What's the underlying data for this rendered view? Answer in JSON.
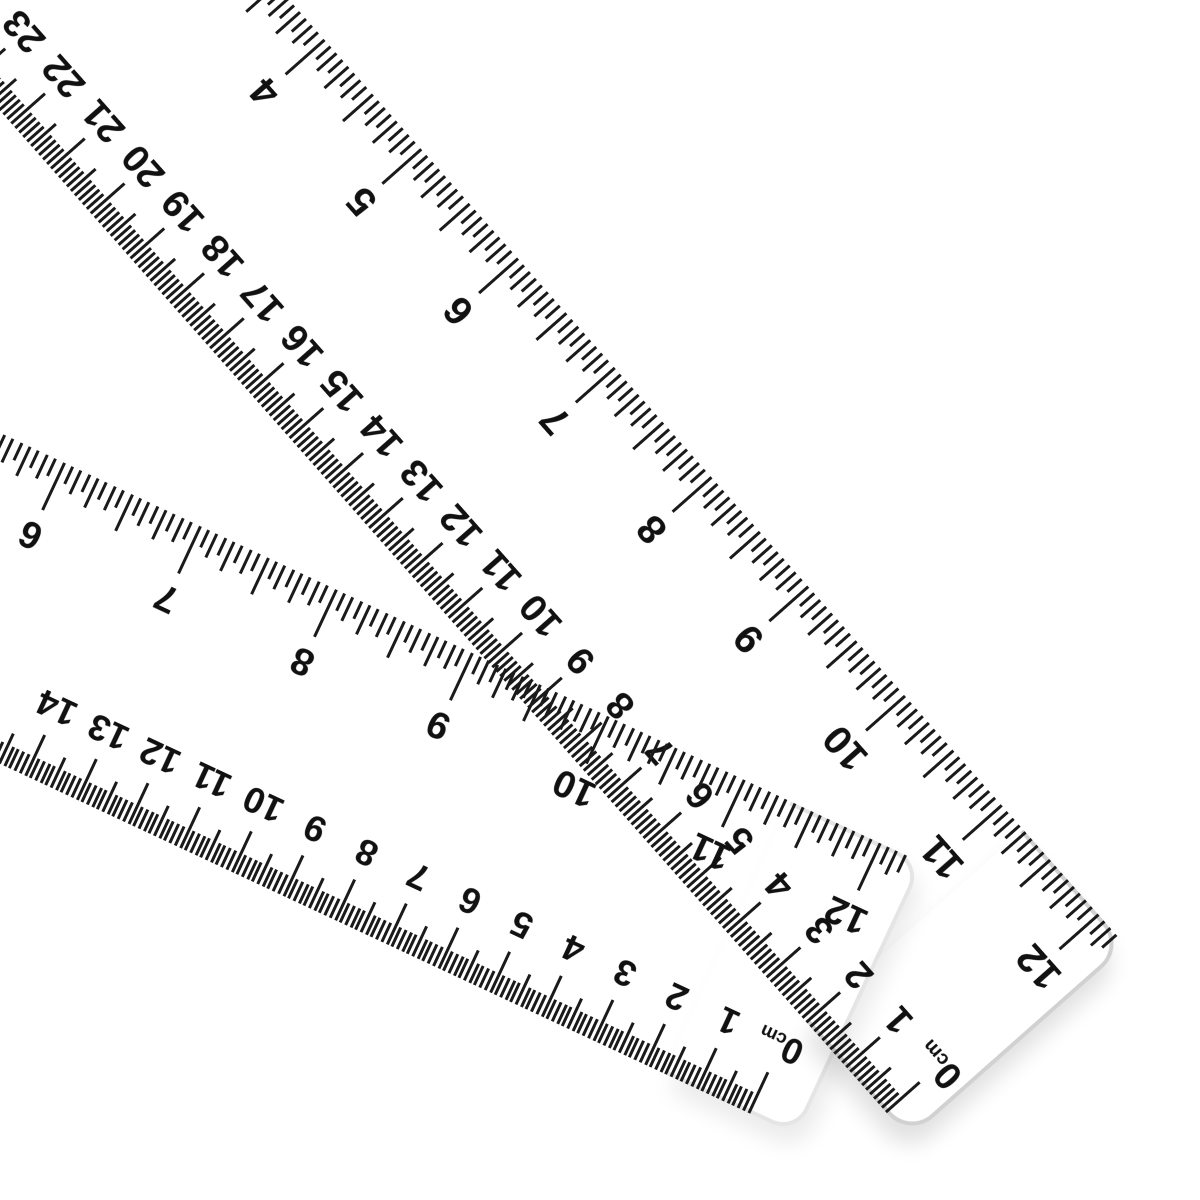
{
  "canvas": {
    "width": 1200,
    "height": 1200,
    "background_color": "#ffffff"
  },
  "style": {
    "tick_color": "#1a1a1a",
    "number_color": "#111111",
    "endcap_outline_color_strong": "rgba(0,0,0,0.18)",
    "endcap_outline_color_faint": "rgba(0,0,0,0.10)",
    "endcap_shadow_strong": "rgba(0,0,0,0.12)",
    "endcap_shadow_faint": "rgba(0,0,0,0.08)"
  },
  "rulers": [
    {
      "id": "ruler-a",
      "angle_deg": 48.5,
      "origin_x": -131,
      "origin_y": -475,
      "length_px": 1900,
      "width_px": 290,
      "endcap": {
        "left": 1742,
        "width": 152,
        "corner_radius": 32,
        "outline": "strong",
        "shadow": "strong"
      },
      "scales": [
        {
          "name": "inch",
          "side": "top",
          "subdivisions": 16,
          "px_per_unit": 146,
          "ref_value": 12,
          "ref_x": 1855,
          "value_sign": 1,
          "min_value": 0,
          "max_value": 12.1875,
          "tick_lengths": {
            "unit": 52,
            "half": 40,
            "quarter": 32,
            "eighth": 26,
            "minor": 19
          },
          "tick_width": 3,
          "number_font_px": 40,
          "number_inset_px": 58,
          "numbers": [
            4,
            5,
            6,
            7,
            8,
            9,
            10,
            11,
            12
          ],
          "zero_label": null
        },
        {
          "name": "cm",
          "side": "bottom",
          "subdivisions": 10,
          "px_per_unit": 60,
          "ref_value": 0,
          "ref_x": 1862,
          "value_sign": -1,
          "min_value": 0,
          "max_value": 31,
          "tick_lengths": {
            "unit": 45,
            "half": 33,
            "quarter": 22,
            "eighth": 22,
            "minor": 22
          },
          "tick_width": 3,
          "number_font_px": 38,
          "number_inset_px": 52,
          "numbers": [
            23,
            22,
            21,
            20,
            19,
            18,
            17,
            16,
            15,
            14,
            13,
            12,
            11,
            10,
            9,
            8,
            7,
            6,
            5,
            4,
            3,
            2,
            1
          ],
          "zero_label": {
            "number": "0",
            "unit": "cm"
          }
        }
      ]
    },
    {
      "id": "ruler-b",
      "angle_deg": 25,
      "origin_x": -525,
      "origin_y": 188,
      "length_px": 1600,
      "width_px": 300,
      "endcap": {
        "left": 1452,
        "width": 142,
        "corner_radius": 28,
        "outline": "faint",
        "shadow": "faint"
      },
      "scales": [
        {
          "name": "inch",
          "side": "top",
          "subdivisions": 16,
          "px_per_unit": 150,
          "ref_value": 12,
          "ref_x": 1550,
          "value_sign": 1,
          "min_value": 0,
          "max_value": 12.1875,
          "tick_lengths": {
            "unit": 52,
            "half": 40,
            "quarter": 32,
            "eighth": 26,
            "minor": 19
          },
          "tick_width": 3,
          "number_font_px": 38,
          "number_inset_px": 58,
          "numbers": [
            6,
            7,
            8,
            9,
            10,
            11,
            12
          ],
          "zero_label": null
        },
        {
          "name": "cm",
          "side": "bottom",
          "subdivisions": 10,
          "px_per_unit": 57,
          "ref_value": 0,
          "ref_x": 1545,
          "value_sign": -1,
          "min_value": 0,
          "max_value": 28,
          "tick_lengths": {
            "unit": 45,
            "half": 33,
            "quarter": 21,
            "eighth": 21,
            "minor": 21
          },
          "tick_width": 3,
          "number_font_px": 36,
          "number_inset_px": 56,
          "numbers": [
            14,
            13,
            12,
            11,
            10,
            9,
            8,
            7,
            6,
            5,
            4,
            3,
            2,
            1
          ],
          "zero_label": {
            "number": "0",
            "unit": "cm"
          }
        }
      ]
    }
  ]
}
